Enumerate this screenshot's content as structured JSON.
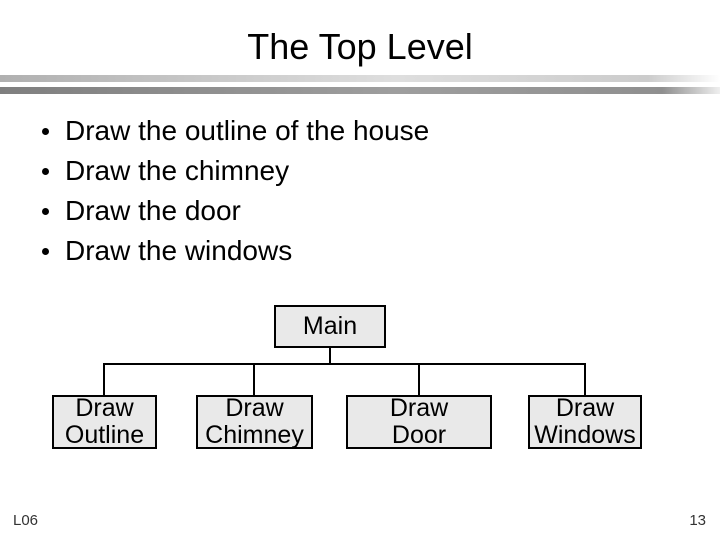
{
  "slide": {
    "title": "The Top Level",
    "bullets": [
      "Draw the outline of the house",
      "Draw the chimney",
      "Draw the door",
      "Draw the windows"
    ],
    "footer_left": "L06",
    "page_number": "13"
  },
  "diagram": {
    "root": {
      "label": "Main"
    },
    "children": [
      {
        "label": "Draw\nOutline"
      },
      {
        "label": "Draw\nChimney"
      },
      {
        "label": "Draw\nDoor"
      },
      {
        "label": "Draw\nWindows"
      }
    ]
  },
  "colors": {
    "background": "#ffffff",
    "text": "#000000",
    "box_fill": "#e9e9e9",
    "box_border": "#000000",
    "divider_top_gray": "#b0b0b0",
    "divider_bottom_gray": "#7f7f7f"
  }
}
